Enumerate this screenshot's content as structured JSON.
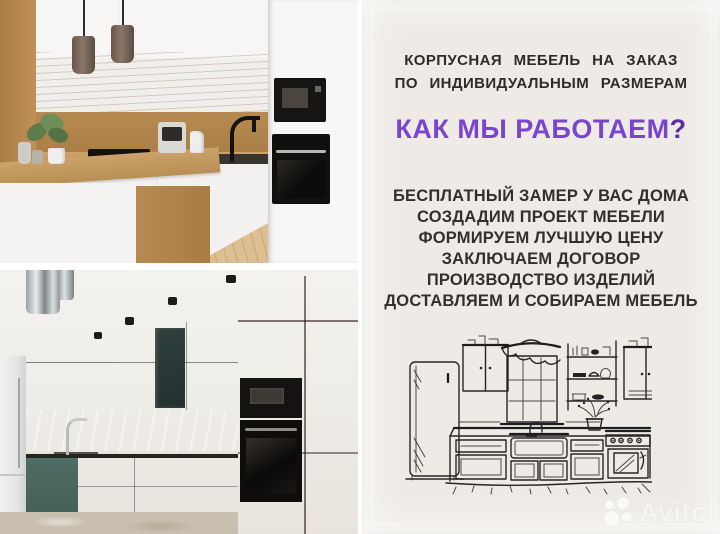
{
  "panel": {
    "heading": {
      "line1": "КОРПУСНАЯ МЕБЕЛЬ НА ЗАКАЗ",
      "line2": "ПО ИНДИВИДУАЛЬНЫМ РАЗМЕРАМ"
    },
    "subheading": {
      "text": "КАК МЫ РАБОТАЕМ",
      "question_mark": "?"
    },
    "steps": [
      "БЕСПЛАТНЫЙ ЗАМЕР У ВАС ДОМА",
      "СОЗДАДИМ ПРОЕКТ МЕБЕЛИ",
      "ФОРМИРУЕМ ЛУЧШУЮ ЦЕНУ",
      "ЗАКЛЮЧАЕМ ДОГОВОР",
      "ПРОИЗВОДСТВО ИЗДЕЛИЙ",
      "ДОСТАВЛЯЕМ И СОБИРАЕМ МЕБЕЛЬ"
    ],
    "colors": {
      "accent_purple": "#7b44cf",
      "question_mark_purple": "#5b2da8",
      "heading_text": "#2f2b28",
      "paper_background": "#eeebe7"
    }
  },
  "photos": {
    "top": {
      "description": "white and oak modern kitchen photo"
    },
    "bottom": {
      "description": "teal and oak kitchen photo"
    }
  },
  "sketch": {
    "description": "hand-drawn kitchen line sketch"
  },
  "watermark": {
    "label": "Avito"
  }
}
